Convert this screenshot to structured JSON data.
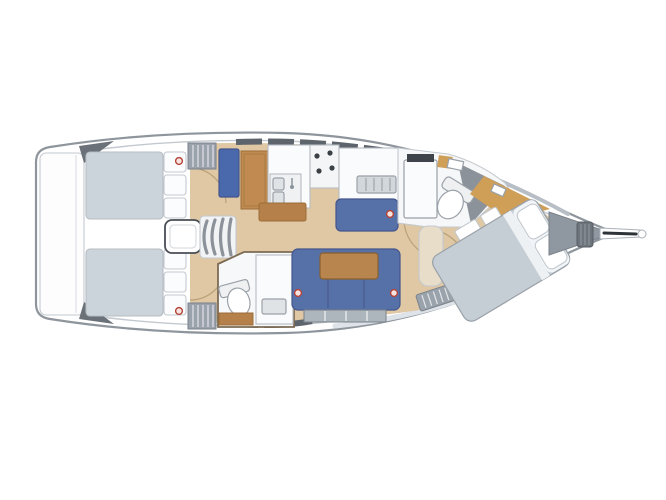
{
  "vessel": {
    "view": "deck-and-interior-plan",
    "bow_direction": "right",
    "areas": [
      "swim-platform",
      "cockpit",
      "companionway",
      "port-aft-cabin",
      "starboard-aft-cabin",
      "chart-table",
      "galley",
      "salon",
      "aft-head",
      "forward-head",
      "owners-cabin",
      "anchor-locker",
      "bowsprit"
    ]
  },
  "colors": {
    "background": "#ffffff",
    "hull_fill": "#ffffff",
    "hull_stroke": "#8e959c",
    "inner_line": "#c3c9cf",
    "stern_trim": "#6a7178",
    "hull_shadow_bottom": "#dde3e9",
    "hull_shadow_top": "#b7bec6",
    "window_band": "#5d646c",
    "cockpit_cushion": "#ccd4db",
    "seat_back_white": "#fbfcfd",
    "floor_wood": "#dfc8a3",
    "furniture_wood": "#c08a50",
    "cabinet_wood": "#b5804a",
    "table_wood": "#b9854e",
    "accent_wood": "#cf9f58",
    "settee_blue": "#5670a8",
    "nav_seat_blue": "#4a69ac",
    "mattress_gray": "#c5cdd5",
    "pillow_white": "#ffffff",
    "pillow_zone": "#f2f5f7",
    "sheet_fold": "#eef1f4",
    "fixture_white": "#fafbfc",
    "counter_gray": "#d2d7db",
    "sink_gray": "#dfe3e6",
    "shower_gray": "#8b9299",
    "anchor_gray": "#8f97a0",
    "windlass_gray": "#6d747b",
    "stripe_gray": "#9aa2ab",
    "beige_seat": "#e8ddc9",
    "locker_gray": "#aeb6bd",
    "burner_dark": "#3a3f45",
    "mirror_dark": "#3f444a",
    "bowsprit_dark": "#2e3338",
    "marker_red": "#b5443a",
    "head_floor": "#f6f7f8",
    "steps_white": "#f2f3f5",
    "platform_white": "#fdfdfe",
    "compartment_white": "#f7f8f9",
    "stove_white": "#f4f5f6",
    "sink_unit_gray": "#eff1f3",
    "tank_white": "#eef0f2"
  }
}
